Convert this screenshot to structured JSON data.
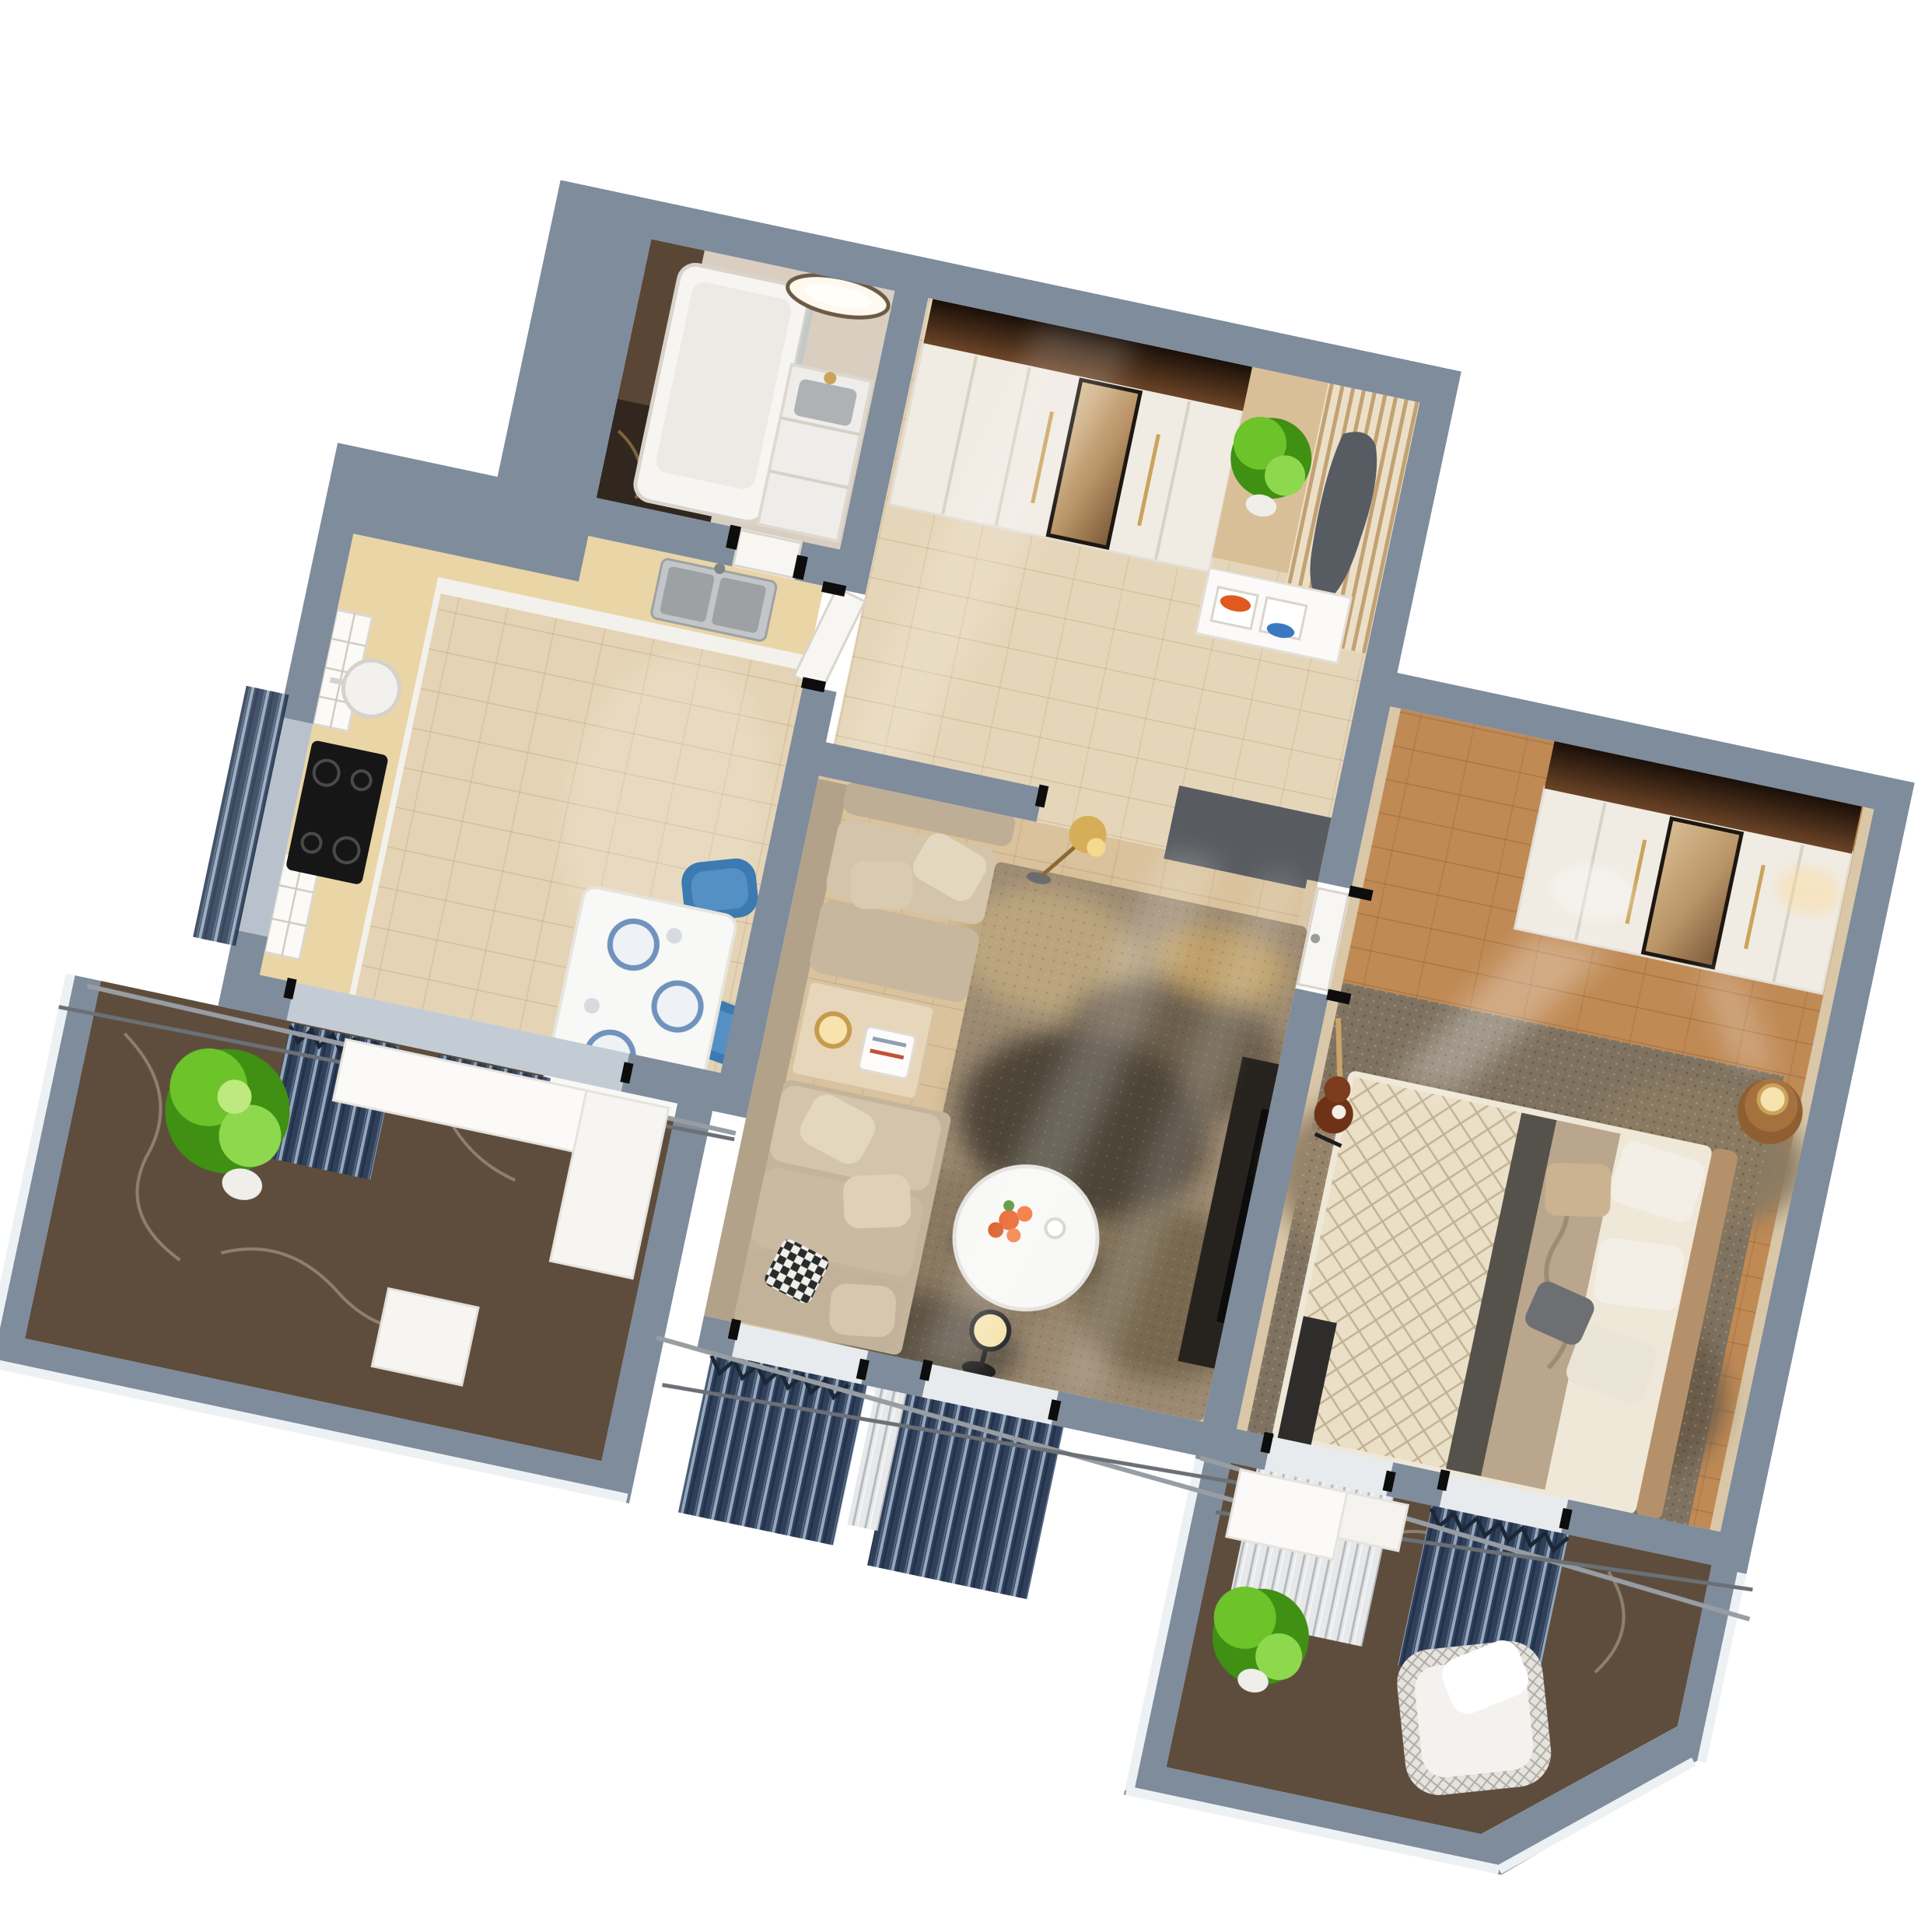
{
  "scene": {
    "type": "3d-floorplan-render",
    "label": "apartment-3d-floor-plan-top-view",
    "background": "#ffffff",
    "rotation_deg": 12
  },
  "palette": {
    "wall": "#7e8c9c",
    "wallLight": "#93a1b0",
    "wallDark": "#69788a",
    "parapetHi": "#eef1f3",
    "floorEntry": "#e6d6b9",
    "floorKitchen": "#e4d3b4",
    "floorLiving": "#d9c29c",
    "floorBedroom": "#c08a55",
    "innerWall": "#d9c7a8",
    "counter": "#e9d3a2",
    "cabinet": "#f3f1ec",
    "marbleBalcony": "#5e4d3d",
    "marbleVein": "#e8ddcc",
    "bathFloorDark": "#31271f",
    "bathMarble": "#d9cec0",
    "bathBrown": "#5a4634",
    "tub": "#f6f5f2",
    "sinkSteel": "#aeb2b5",
    "sofa": "#c9b9a1",
    "rugBase": "#9c8a72",
    "rugDark": "#4e4438",
    "bedRugBase": "#7f7260",
    "table": "#f8f8f6",
    "chairBlue": "#3c7ab2",
    "plateBlue": "#6f93bd",
    "plantGreen": "#6cc32a",
    "quilt": "#eadfc7",
    "runner": "#55524c",
    "headboard": "#b5916b",
    "wardrobeCrown": "#1a0f08",
    "wardrobeDoor": "#f0ebe3",
    "coat": "#565c62",
    "shoeOrange": "#e05a20",
    "shoeBlue": "#3a79c0",
    "doormat": "#585c60",
    "tvConsole": "#26231f",
    "lampGold": "#d7ae58",
    "lampGlow": "#f6e3ae",
    "curtainDark": "#31405a",
    "curtainLight": "#e7e8ea",
    "rail": "#979da3",
    "flowerOrange": "#e8571d",
    "guitar": "#6e3317"
  },
  "rooms": [
    {
      "id": "bathroom",
      "furniture": [
        "bathtub",
        "vanity-with-sink",
        "gold-faucet",
        "backlit-round-mirror",
        "marble-walls",
        "dark-marble-floor"
      ]
    },
    {
      "id": "entry-hall",
      "furniture": [
        "wardrobe-with-mirror",
        "potted-plant",
        "slat-coat-rack",
        "hanging-coat",
        "shoe-bench",
        "orange-shoes",
        "blue-shoes",
        "doormat"
      ]
    },
    {
      "id": "kitchen",
      "furniture": [
        "l-shaped-counter",
        "glass-upper-cabinets",
        "double-sink",
        "black-cooktop",
        "oven",
        "cooking-pot",
        "dining-table",
        "blue-chairs",
        "plates"
      ]
    },
    {
      "id": "living-room",
      "furniture": [
        "sectional-sofa",
        "beige-cushions",
        "checkered-pillow",
        "side-table",
        "table-lamp",
        "round-coffee-table",
        "orange-flowers",
        "abstract-area-rug",
        "tv-console",
        "gold-floor-lamp",
        "black-floor-lamp",
        "dark-curtains"
      ]
    },
    {
      "id": "bedroom",
      "furniture": [
        "double-bed",
        "quilted-blanket",
        "gray-bed-runner",
        "white-pillows",
        "gray-pillows",
        "headboard",
        "round-nightstand",
        "bedside-lamp",
        "wardrobe-with-mirror",
        "area-rug",
        "guitar-on-stand",
        "curtains"
      ]
    },
    {
      "id": "balcony-left",
      "furniture": [
        "white-bench",
        "white-stool",
        "potted-plant",
        "dark-marble-floor",
        "white-parapet"
      ]
    },
    {
      "id": "balcony-right",
      "furniture": [
        "white-bench",
        "wicker-armchair",
        "potted-plant",
        "dark-marble-floor",
        "chamfered-parapet"
      ]
    }
  ]
}
